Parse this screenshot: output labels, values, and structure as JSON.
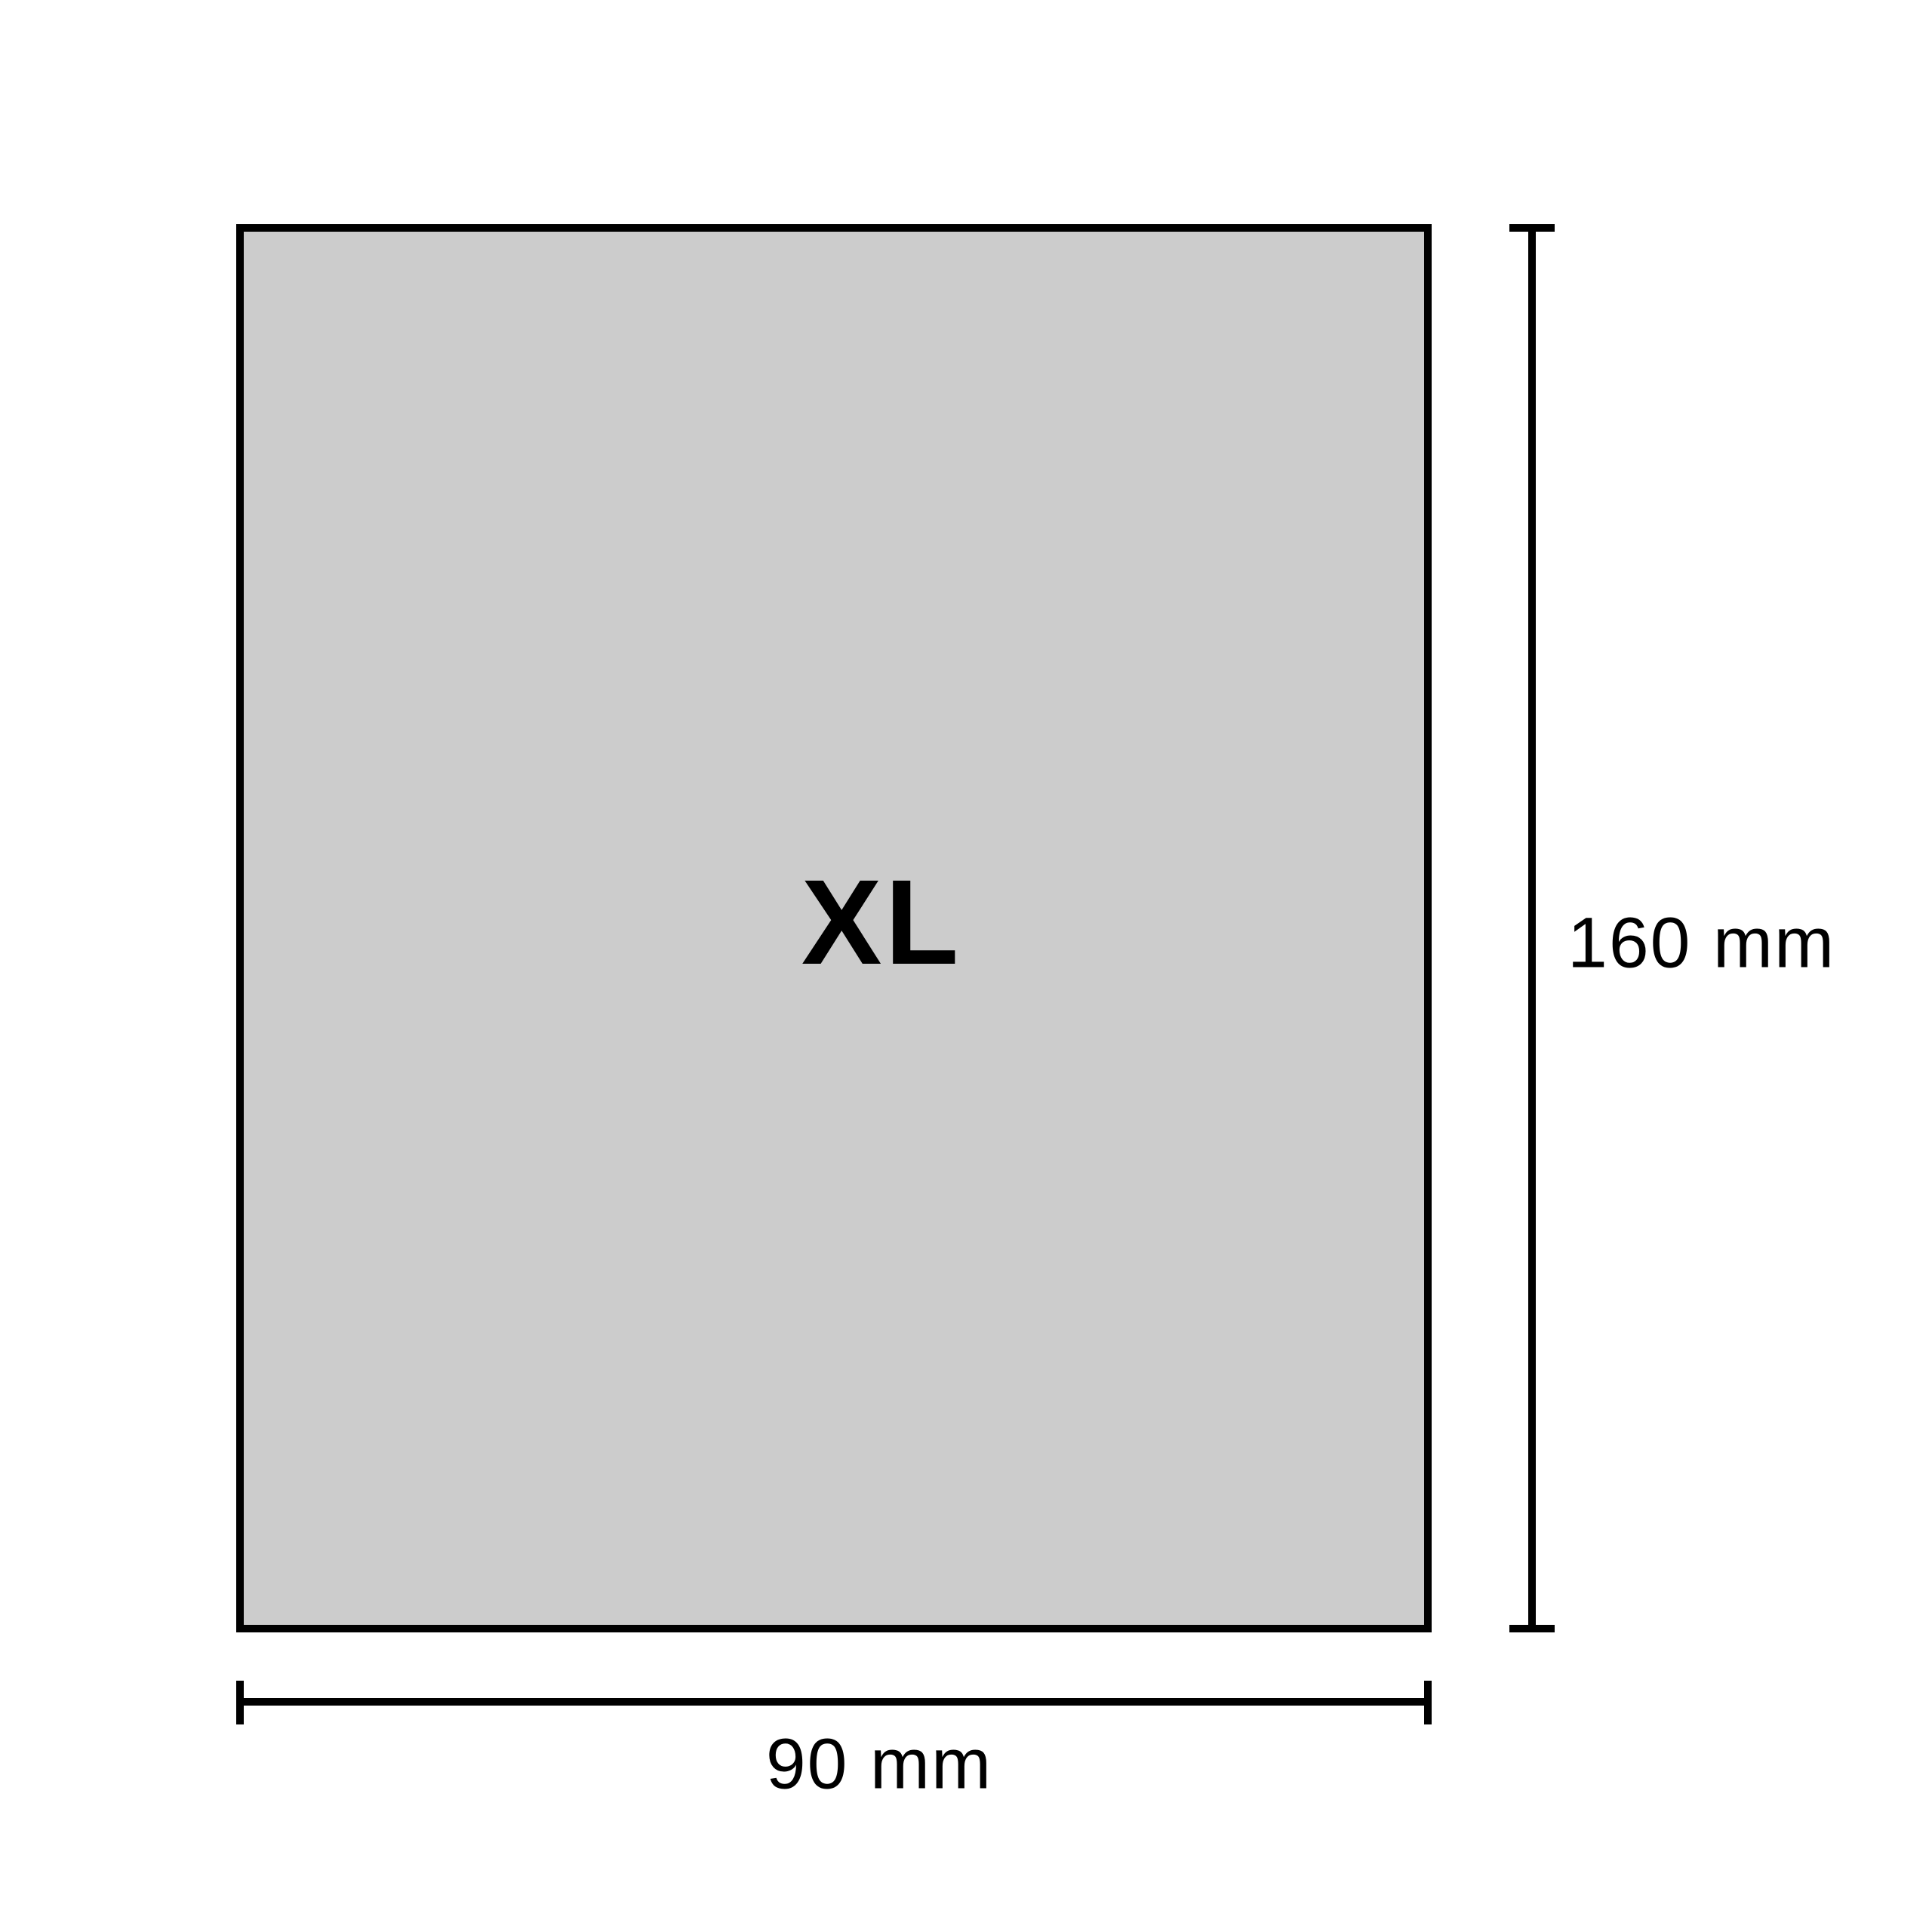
{
  "diagram": {
    "size_label": "XL",
    "height_dimension": {
      "label": "160 mm"
    },
    "width_dimension": {
      "label": "90 mm"
    },
    "colors": {
      "rect_fill": "#cccccc",
      "line_stroke": "#000000",
      "background": "#ffffff",
      "text": "#000000"
    }
  }
}
